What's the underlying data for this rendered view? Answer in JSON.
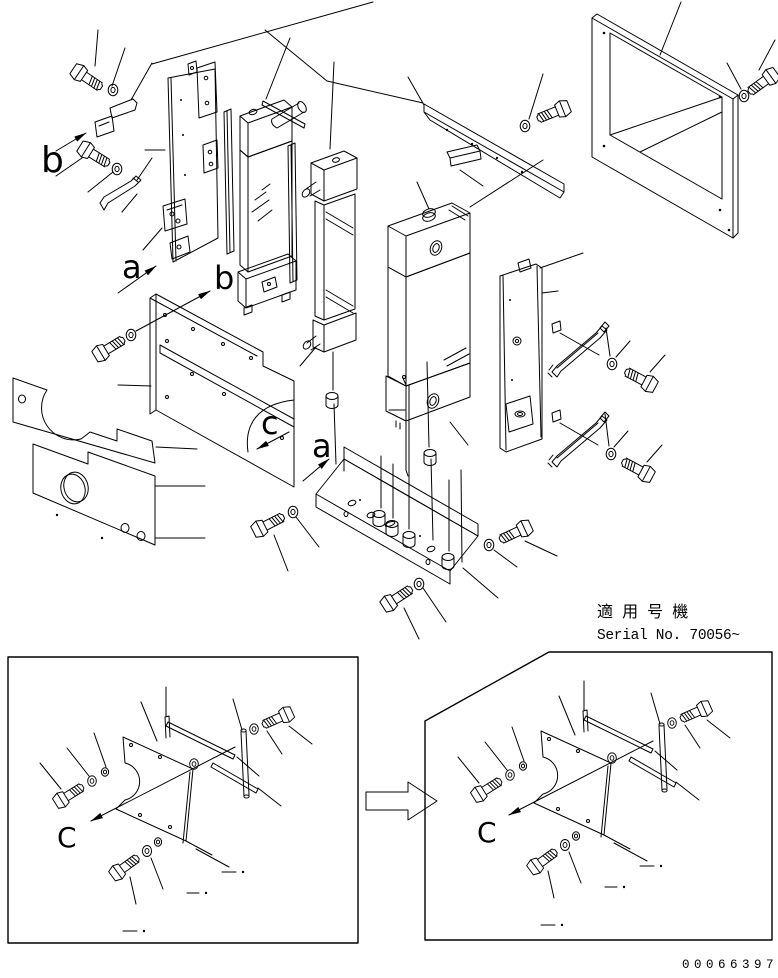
{
  "drawing": {
    "ink_color": "#000000",
    "paper_color": "#ffffff",
    "callouts": {
      "b_upper": "b",
      "a_upper": "a",
      "b_mid": "b",
      "a_lower": "a",
      "c_main": "c",
      "detail_c_left": "C",
      "detail_c_right": "C"
    },
    "applicability": {
      "jp_label": "適 用 号 機",
      "serial_label": "Serial No. 70056~"
    },
    "doc_number": "00066397"
  }
}
